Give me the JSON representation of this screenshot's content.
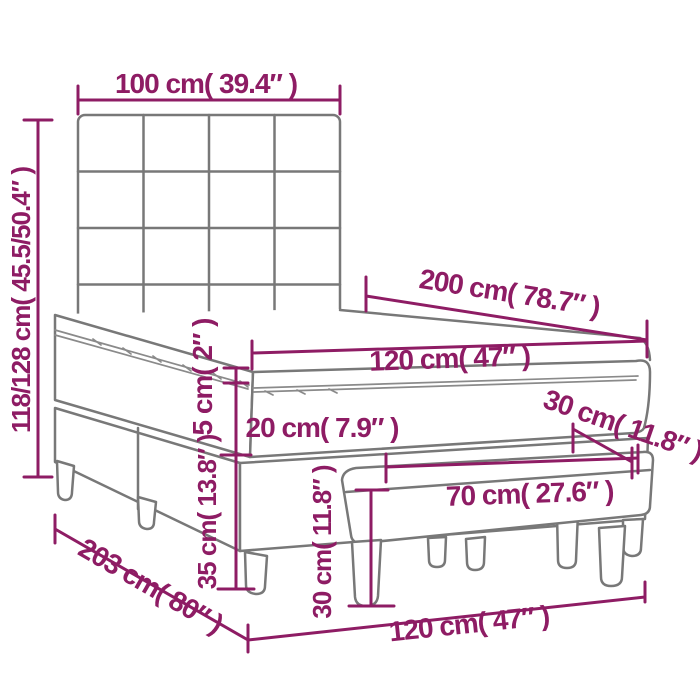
{
  "diagram": {
    "kind": "product dimension diagram",
    "subject": "box spring bed with square-tufted headboard, mattress with topper, and footstool bench",
    "colors": {
      "dimension_accent": "#8e1c64",
      "furniture_outline": "#787878",
      "background": "#ffffff"
    },
    "labels": {
      "headboard_width": "100 cm( 39.4″ )",
      "total_height": "118/128 cm( 45.5/50.4″ )",
      "bed_length": "200 cm( 78.7″ )",
      "mattress_width_top": "120 cm( 47″ )",
      "topper_thickness": "5 cm( 2″ )",
      "mattress_thickness": "20 cm( 7.9″ )",
      "base_height": "35 cm( 13.8″ )",
      "bench_depth": "30 cm( 11.8″ )",
      "bench_width": "70 cm( 27.6″ )",
      "bench_height": "30 cm( 11.8″ )",
      "base_length": "203 cm( 80″ )",
      "base_width": "120 cm( 47″ )"
    }
  }
}
